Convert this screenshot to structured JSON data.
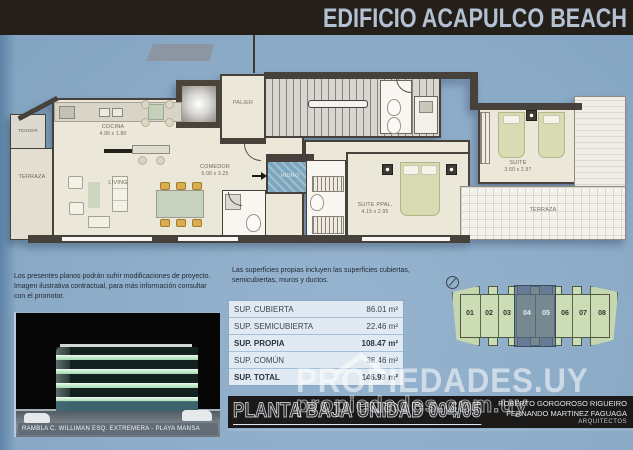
{
  "header": {
    "title": "EDIFICIO ACAPULCO BEACH"
  },
  "plan": {
    "tender": {
      "name": "TENDER"
    },
    "terraza_izq": {
      "name": "TERRAZA"
    },
    "cocina": {
      "name": "COCINA",
      "dims": "4.90 x 1.80"
    },
    "living": {
      "name": "LIVING"
    },
    "comedor": {
      "name": "COMEDOR",
      "dims": "6.00 x 3.25"
    },
    "palier": {
      "name": "PALIER"
    },
    "hidro": {
      "name": "HIDRO"
    },
    "suite_ppal": {
      "name": "SUITE PPAL.",
      "dims": "4.15 x 2.95"
    },
    "suite": {
      "name": "SUITE",
      "dims": "3.60 x 2.97"
    },
    "terraza_der": {
      "name": "TERRAZA"
    }
  },
  "notes": {
    "disclaimer": "Los presentes planos podrán sufrir modificaciones de proyecto. Imagen ilustrativa contractual, para más información consultar con el promotor.",
    "superficies": "Las superficies propias incluyen las superficies cubiertas, semicubiertas, muros y ductos."
  },
  "areas_table": {
    "rows": [
      {
        "label": "SUP. CUBIERTA",
        "value": "86.01 m²"
      },
      {
        "label": "SUP. SEMICUBIERTA",
        "value": "22.46 m²"
      },
      {
        "label": "SUP. PROPIA",
        "value": "108.47 m²"
      },
      {
        "label": "SUP. COMÚN",
        "value": "38.46 m²"
      },
      {
        "label": "SUP. TOTAL",
        "value": "146.93 m²"
      }
    ]
  },
  "render": {
    "caption": "RAMBLA C. WILLIMAN ESQ. EXTREMERA - PLAYA MANSA"
  },
  "title_bar": {
    "title": "PLANTA BAJA UNIDAD 004/05"
  },
  "architects": {
    "line1": "ROBERTO GORGOROSO RIGUEIRO",
    "line2": "FERNANDO MARTINEZ FAGUAGA",
    "line3": "ARQUITECTOS"
  },
  "key_plan": {
    "units": [
      "01",
      "02",
      "03",
      "04",
      "05",
      "06",
      "07",
      "08"
    ],
    "highlighted_units": "04, 05"
  },
  "watermark": {
    "main": "PROPIEDADES.UY",
    "url": "propiedades.com.uy"
  },
  "colors": {
    "background_blue": "#8cabc7",
    "header_dark": "#242019",
    "plan_floor": "#ece8d9",
    "wall_dark": "#46413b",
    "water_blue": "#7ca6bd",
    "keyplan_green": "#ccdcb4",
    "keyplan_highlight": "#546882",
    "table_border": "#8aa9c4"
  }
}
